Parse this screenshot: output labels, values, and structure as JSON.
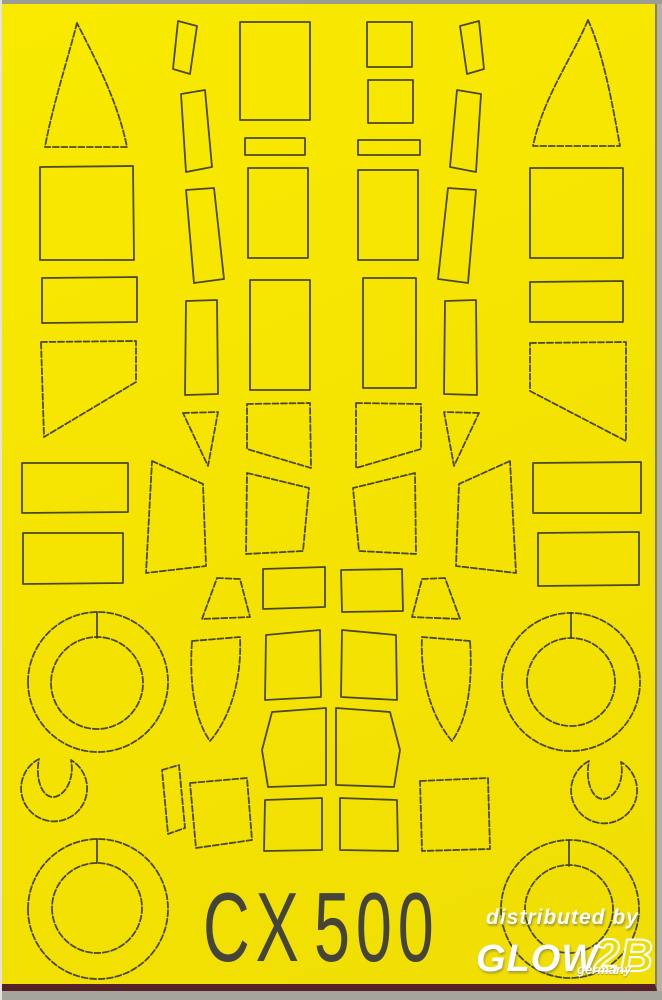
{
  "sheet": {
    "code_prefix": "CX",
    "code_number": "500",
    "background_color": "#f5e402",
    "line_color": "#3c3b2e",
    "border_bottom_color": "#572226",
    "surround_color": "#b2b2a8",
    "text_color": "#45443a"
  },
  "watermark": {
    "line1": "distributed by",
    "brand": "GLOW",
    "brand_suffix": "2B",
    "line3": "germany",
    "color": "#ffffff"
  },
  "shapes": [
    {
      "name": "mask-windscreen-left",
      "path": "M77,23 C68,58 52,108 45,147 L127,147 C117,98 93,55 77,23 Z",
      "dashed": true
    },
    {
      "name": "mask-rect-a1",
      "path": "M40,167 L133,166 L134,260 L40,260 Z",
      "dashed": false
    },
    {
      "name": "mask-rect-a2",
      "path": "M42,278 L137,277 L137,322 L42,323 Z",
      "dashed": false
    },
    {
      "name": "mask-pentagon-left",
      "path": "M41,342 L136,341 L136,382 L44,437 Z",
      "dashed": true
    },
    {
      "name": "mask-rect-a3",
      "path": "M22,463 L128,463 L128,512 L22,513 Z",
      "dashed": false
    },
    {
      "name": "mask-rect-a4",
      "path": "M23,533 L123,533 L123,583 L23,584 Z",
      "dashed": false
    },
    {
      "name": "mask-wheel-mid-left-outer",
      "path": "M28,682 a70,70 0 1 0 140,0 a70,70 0 1 0 -140,0",
      "dashed": true
    },
    {
      "name": "mask-wheel-mid-left-inner",
      "path": "M51,683 a46,46 0 1 0 92,0 a46,46 0 1 0 -92,0",
      "dashed": true
    },
    {
      "name": "mask-wheel-mid-left-split",
      "path": "M97,612 L97,638",
      "dashed": false
    },
    {
      "name": "mask-windscreen-right",
      "path": "M588,20 C604,55 613,108 620,146 L533,146 C543,98 572,58 588,20 Z",
      "dashed": true
    },
    {
      "name": "mask-rect-f1",
      "path": "M530,168 L623,168 L623,258 L530,258 Z",
      "dashed": false
    },
    {
      "name": "mask-rect-f2",
      "path": "M530,282 L623,281 L623,322 L530,322 Z",
      "dashed": false
    },
    {
      "name": "mask-pentagon-right",
      "path": "M530,343 L626,342 L626,441 L530,391 Z",
      "dashed": true
    },
    {
      "name": "mask-rect-f3",
      "path": "M533,463 L641,462 L641,513 L533,513 Z",
      "dashed": false
    },
    {
      "name": "mask-rect-f4",
      "path": "M538,533 L639,532 L639,585 L538,586 Z",
      "dashed": false
    },
    {
      "name": "mask-wheel-mid-right-outer",
      "path": "M502,682 a69,69 0 1 0 138,0 a69,69 0 1 0 -138,0",
      "dashed": true
    },
    {
      "name": "mask-wheel-mid-right-inner",
      "path": "M527,682 a44,44 0 1 0 88,0 a44,44 0 1 0 -88,0",
      "dashed": true
    },
    {
      "name": "mask-wheel-mid-right-split",
      "path": "M571,613 L571,638",
      "dashed": false
    },
    {
      "name": "mask-strip-b1",
      "path": "M178,21 L197,26 L190,74 L173,69 Z",
      "dashed": false
    },
    {
      "name": "mask-strip-b2",
      "path": "M181,94 L205,90 L212,167 L186,172 Z",
      "dashed": false
    },
    {
      "name": "mask-strip-b3",
      "path": "M186,190 L214,188 L224,279 L194,283 Z",
      "dashed": false
    },
    {
      "name": "mask-rect-b4",
      "path": "M186,301 L217,300 L218,394 L185,395 Z",
      "dashed": false
    },
    {
      "name": "mask-triangle-b5",
      "path": "M183,413 L218,412 L208,466 Z",
      "dashed": true
    },
    {
      "name": "mask-strip-e1",
      "path": "M479,21 L460,26 L467,74 L484,69 Z",
      "dashed": false
    },
    {
      "name": "mask-strip-e2",
      "path": "M481,94 L457,90 L450,167 L476,172 Z",
      "dashed": false
    },
    {
      "name": "mask-strip-e3",
      "path": "M476,190 L448,188 L438,279 L468,283 Z",
      "dashed": false
    },
    {
      "name": "mask-rect-e4",
      "path": "M476,300 L445,301 L444,394 L477,395 Z",
      "dashed": false
    },
    {
      "name": "mask-triangle-e5",
      "path": "M479,413 L444,412 L454,466 Z",
      "dashed": true
    },
    {
      "name": "mask-rect-c1",
      "path": "M240,22 L310,22 L310,120 L240,120 Z",
      "dashed": false
    },
    {
      "name": "mask-rect-c2",
      "path": "M245,138 L305,138 L305,155 L245,155 Z",
      "dashed": false
    },
    {
      "name": "mask-rect-c3",
      "path": "M248,168 L308,168 L308,258 L248,258 Z",
      "dashed": false
    },
    {
      "name": "mask-rect-c4",
      "path": "M250,280 L310,280 L310,390 L250,390 Z",
      "dashed": false
    },
    {
      "name": "mask-quad-c5",
      "path": "M247,404 L310,403 L311,468 L247,449 Z",
      "dashed": true
    },
    {
      "name": "mask-quad-c6",
      "path": "M247,473 L309,488 L303,551 L246,554 Z",
      "dashed": true
    },
    {
      "name": "mask-square-d1",
      "path": "M367,22 L412,22 L412,67 L367,67 Z",
      "dashed": false
    },
    {
      "name": "mask-square-d2",
      "path": "M368,80 L413,80 L413,123 L368,123 Z",
      "dashed": false
    },
    {
      "name": "mask-rect-d3",
      "path": "M358,140 L420,140 L420,155 L358,155 Z",
      "dashed": false
    },
    {
      "name": "mask-rect-d4",
      "path": "M358,170 L418,170 L418,260 L358,260 Z",
      "dashed": false
    },
    {
      "name": "mask-rect-d5",
      "path": "M363,278 L416,278 L416,388 L363,388 Z",
      "dashed": false
    },
    {
      "name": "mask-quad-d6",
      "path": "M356,403 L421,404 L421,449 L356,468 Z",
      "dashed": true
    },
    {
      "name": "mask-quad-d7",
      "path": "M415,473 L353,488 L359,551 L416,554 Z",
      "dashed": true
    },
    {
      "name": "mask-panel-left",
      "path": "M152,461 L203,484 L206,566 L146,573 Z",
      "dashed": true
    },
    {
      "name": "mask-panel-right",
      "path": "M510,461 L459,484 L456,566 L516,573 Z",
      "dashed": true
    },
    {
      "name": "mask-trapezoid-left",
      "path": "M217,578 L240,579 L250,617 L202,619 Z",
      "dashed": true
    },
    {
      "name": "mask-trapezoid-right",
      "path": "M445,578 L422,579 L412,617 L460,619 Z",
      "dashed": true
    },
    {
      "name": "mask-blade-left",
      "path": "M192,641 L240,637 C242,680 230,718 210,741 C195,720 189,685 192,641 Z",
      "dashed": true
    },
    {
      "name": "mask-blade-right",
      "path": "M470,641 L422,637 C420,680 432,718 452,741 C467,720 473,685 470,641 Z",
      "dashed": true
    },
    {
      "name": "mask-window-row0-left",
      "path": "M263,569 L325,567 L325,607 L263,609 Z",
      "dashed": false
    },
    {
      "name": "mask-window-row0-right",
      "path": "M341,570 L402,569 L403,611 L342,612 Z",
      "dashed": false
    },
    {
      "name": "mask-window-row1-left",
      "path": "M266,635 L320,630 L321,697 L265,700 Z",
      "dashed": false
    },
    {
      "name": "mask-window-row1-right",
      "path": "M342,630 L396,635 L397,700 L341,697 Z",
      "dashed": false
    },
    {
      "name": "mask-window-row2-left",
      "path": "M272,712 L326,708 L326,785 L268,787 L262,750 Z",
      "dashed": false
    },
    {
      "name": "mask-window-row2-right",
      "path": "M336,708 L390,712 L400,750 L394,787 L336,785 Z",
      "dashed": false
    },
    {
      "name": "mask-window-row3-left",
      "path": "M265,800 L322,798 L322,850 L264,851 Z",
      "dashed": false
    },
    {
      "name": "mask-window-row3-right",
      "path": "M340,798 L397,800 L398,851 L340,850 Z",
      "dashed": false
    },
    {
      "name": "mask-sliver-bottom-left",
      "path": "M162,770 L179,765 L185,828 L168,834 Z",
      "dashed": true
    },
    {
      "name": "mask-quad-bottom-left",
      "path": "M190,783 L247,778 L252,840 L196,848 Z",
      "dashed": true
    },
    {
      "name": "mask-quad-bottom-right",
      "path": "M420,781 L488,778 L490,849 L422,851 Z",
      "dashed": true
    },
    {
      "name": "mask-hub-left",
      "path": "M39,759 A33,33 0 1 0 71,760 C75,780 64,797 53,797 C42,797 35,779 39,759 Z",
      "dashed": true
    },
    {
      "name": "mask-hub-right",
      "path": "M589,761 A33,33 0 1 0 621,762 C625,782 614,799 603,799 C592,799 585,781 589,761 Z",
      "dashed": true
    },
    {
      "name": "mask-wheel-bottom-left-outer",
      "path": "M28,909 a70,70 0 1 0 140,0 a70,70 0 1 0 -140,0",
      "dashed": true
    },
    {
      "name": "mask-wheel-bottom-left-inner",
      "path": "M52,908 a45,45 0 1 0 90,0 a45,45 0 1 0 -90,0",
      "dashed": true
    },
    {
      "name": "mask-wheel-bottom-left-split",
      "path": "M97,839 L97,863",
      "dashed": false
    },
    {
      "name": "mask-wheel-bottom-right-outer",
      "path": "M501,909 a69,69 0 1 0 138,0 a69,69 0 1 0 -138,0",
      "dashed": true
    },
    {
      "name": "mask-wheel-bottom-right-inner",
      "path": "M525,909 a44,44 0 1 0 88,0 a44,44 0 1 0 -88,0",
      "dashed": true
    },
    {
      "name": "mask-wheel-bottom-right-split",
      "path": "M569,840 L569,866",
      "dashed": false
    }
  ]
}
